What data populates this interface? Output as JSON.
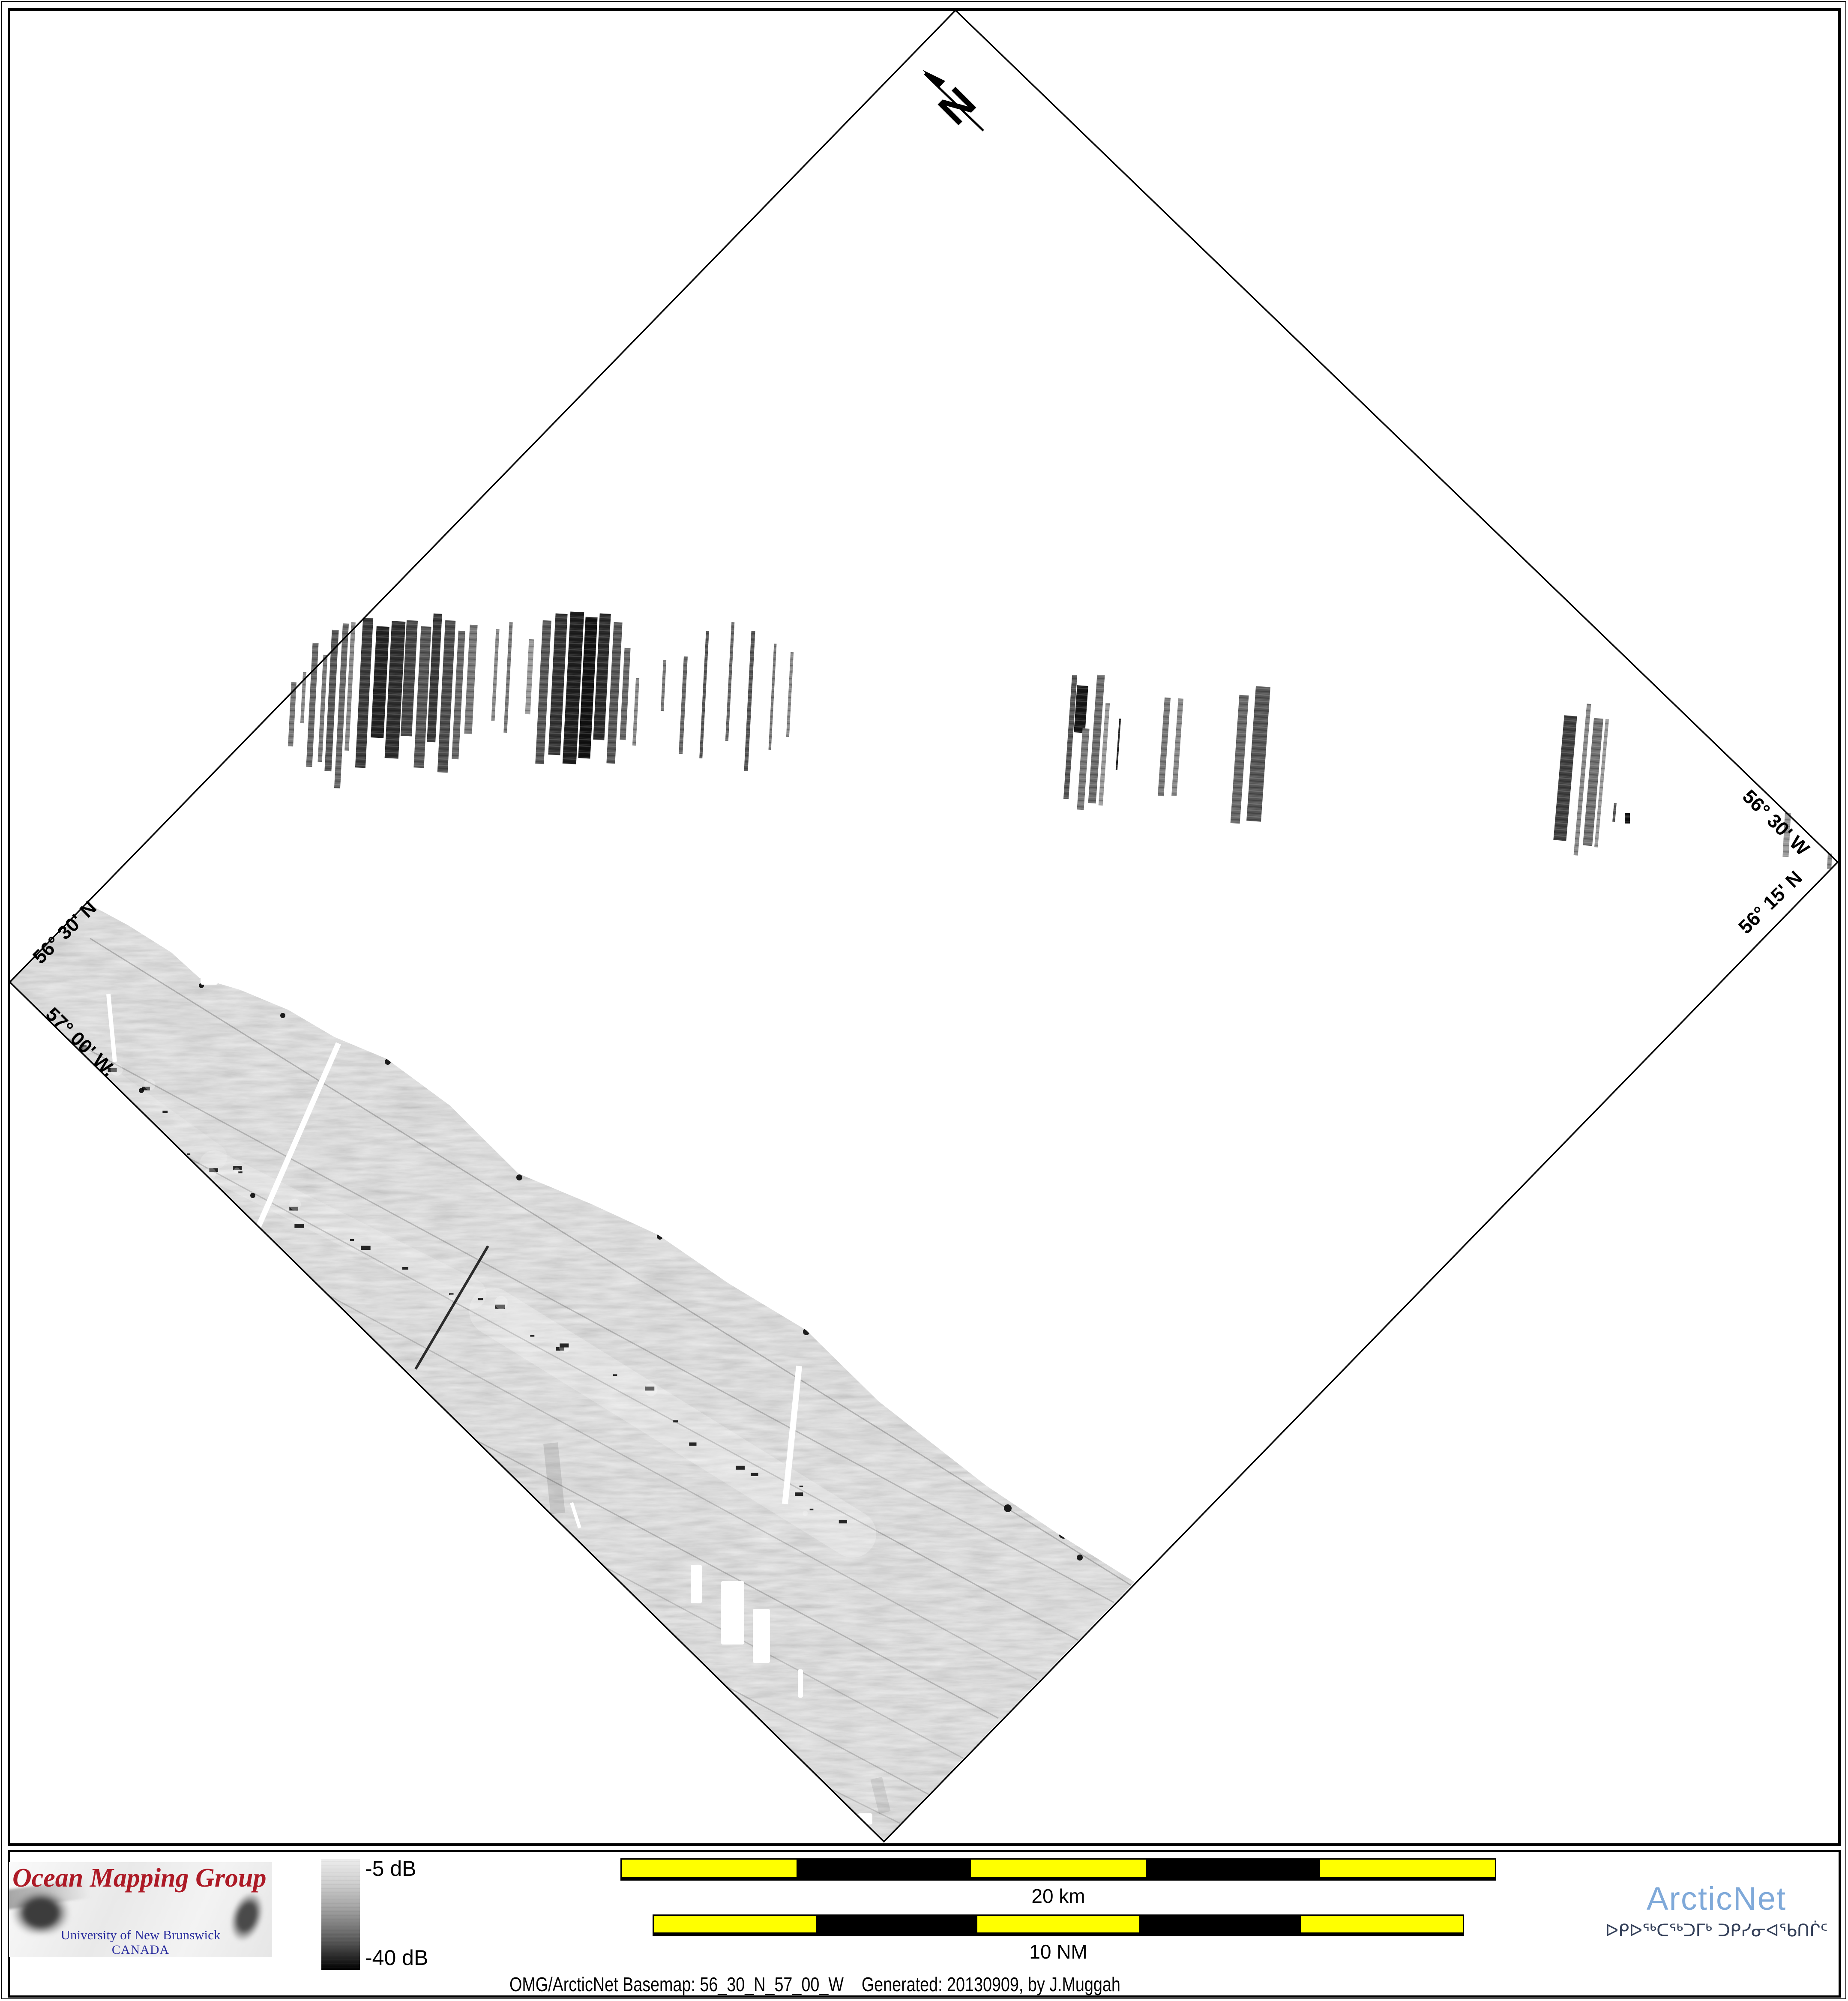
{
  "map": {
    "north_label": "N",
    "corner_labels": {
      "top_left": "56° 30' N",
      "bottom_left": "57° 00' W.",
      "top_right": "56° 30' W",
      "bottom_right": "56° 15' N"
    },
    "diamond": {
      "points": [
        [
          2230,
          24
        ],
        [
          4289,
          2012
        ],
        [
          2063,
          4298
        ],
        [
          23,
          2292
        ]
      ]
    },
    "swath": {
      "base_gray": "#b5b5b5",
      "points": [
        [
          207,
          2110
        ],
        [
          300,
          2160
        ],
        [
          400,
          2223
        ],
        [
          465,
          2282
        ],
        [
          560,
          2310
        ],
        [
          673,
          2357
        ],
        [
          780,
          2420
        ],
        [
          902,
          2471
        ],
        [
          1050,
          2580
        ],
        [
          1210,
          2739
        ],
        [
          1380,
          2810
        ],
        [
          1536,
          2882
        ],
        [
          1700,
          2995
        ],
        [
          1881,
          3104
        ],
        [
          2050,
          3270
        ],
        [
          2300,
          3466
        ],
        [
          2470,
          3580
        ],
        [
          2648,
          3692
        ],
        [
          2063,
          4295
        ],
        [
          23,
          2292
        ]
      ],
      "tracklines": [
        [
          210,
          2190,
          2640,
          3700,
          0.2
        ],
        [
          40,
          2360,
          2600,
          3740,
          0.18
        ],
        [
          30,
          2480,
          2520,
          3830,
          0.2
        ],
        [
          60,
          2640,
          2420,
          3920,
          0.15
        ],
        [
          150,
          2850,
          2330,
          4010,
          0.18
        ],
        [
          330,
          3080,
          2260,
          4110,
          0.14
        ],
        [
          560,
          3330,
          2190,
          4200,
          0.16
        ],
        [
          820,
          3620,
          2130,
          4270,
          0.13
        ]
      ],
      "light_bands": [
        [
          1150,
          3060,
          1990,
          3580,
          110,
          0.25
        ],
        [
          500,
          2720,
          1100,
          3020,
          70,
          0.2
        ],
        [
          250,
          2520,
          500,
          2700,
          60,
          0.15
        ]
      ],
      "smudges": [
        [
          1139,
          2908,
          970,
          3195,
          6,
          0.8
        ],
        [
          1285,
          3368,
          1302,
          3532,
          34,
          0.1
        ],
        [
          2045,
          4150,
          2065,
          4230,
          28,
          0.08
        ]
      ],
      "chain": {
        "points": [
          [
            170,
            2395
          ],
          [
            256,
            2500
          ],
          [
            360,
            2600
          ],
          [
            464,
            2705
          ],
          [
            560,
            2760
          ],
          [
            700,
            2830
          ],
          [
            850,
            2905
          ],
          [
            1000,
            2975
          ],
          [
            1150,
            3050
          ],
          [
            1240,
            3114
          ],
          [
            1380,
            3200
          ],
          [
            1536,
            3290
          ],
          [
            1700,
            3390
          ],
          [
            1810,
            3460
          ],
          [
            1907,
            3529
          ],
          [
            2000,
            3600
          ]
        ],
        "dots_per_segment": 2,
        "jitter": 26,
        "size_min": 5,
        "size_max": 14
      },
      "specks": [
        [
          1212,
          2748,
          7
        ],
        [
          1540,
          2886,
          7
        ],
        [
          1882,
          3108,
          8
        ],
        [
          2352,
          3520,
          9
        ],
        [
          2482,
          3580,
          11
        ],
        [
          660,
          2370,
          6
        ],
        [
          905,
          2478,
          7
        ],
        [
          470,
          2300,
          6
        ],
        [
          2520,
          3635,
          7
        ],
        [
          330,
          2545,
          6
        ],
        [
          590,
          2790,
          6
        ]
      ],
      "gaps": [
        [
          790,
          2435,
          600,
          2870,
          13
        ],
        [
          253,
          2320,
          268,
          2478,
          10
        ],
        [
          1865,
          3188,
          1832,
          3510,
          14
        ],
        [
          1334,
          3507,
          1353,
          3566,
          8
        ]
      ],
      "blobs": [
        [
          1612,
          3652,
          26,
          90
        ],
        [
          1683,
          3690,
          54,
          148
        ],
        [
          1757,
          3755,
          40,
          126
        ],
        [
          1702,
          3948,
          14,
          165
        ],
        [
          1755,
          4058,
          11,
          105
        ],
        [
          1862,
          3896,
          12,
          66
        ],
        [
          2320,
          4072,
          78,
          42
        ],
        [
          2002,
          4232,
          34,
          26
        ],
        [
          468,
          2272,
          40,
          26
        ]
      ]
    },
    "strips": [
      [
        676,
        1592,
        12,
        150,
        "#777777",
        3
      ],
      [
        704,
        1568,
        8,
        120,
        "#888888",
        3
      ],
      [
        722,
        1500,
        14,
        290,
        "#666666",
        3
      ],
      [
        748,
        1528,
        10,
        250,
        "#777777",
        3
      ],
      [
        766,
        1470,
        16,
        330,
        "#555555",
        3
      ],
      [
        790,
        1455,
        14,
        385,
        "#666666",
        3
      ],
      [
        812,
        1452,
        10,
        300,
        "#888888",
        3
      ],
      [
        838,
        1442,
        24,
        350,
        "#3a3a3a",
        3
      ],
      [
        872,
        1462,
        30,
        260,
        "#222222",
        3
      ],
      [
        906,
        1450,
        32,
        320,
        "#2d2d2d",
        3
      ],
      [
        942,
        1448,
        26,
        270,
        "#444444",
        3
      ],
      [
        974,
        1462,
        24,
        330,
        "#555555",
        3
      ],
      [
        1004,
        1432,
        20,
        300,
        "#383838",
        3
      ],
      [
        1030,
        1448,
        24,
        355,
        "#4a4a4a",
        3
      ],
      [
        1062,
        1472,
        16,
        300,
        "#666666",
        3
      ],
      [
        1090,
        1458,
        18,
        255,
        "#777777",
        3
      ],
      [
        1152,
        1468,
        8,
        215,
        "#888888",
        3
      ],
      [
        1182,
        1452,
        8,
        258,
        "#777777",
        3
      ],
      [
        1230,
        1492,
        12,
        175,
        "#999999",
        3
      ],
      [
        1258,
        1448,
        20,
        335,
        "#555555",
        3
      ],
      [
        1288,
        1432,
        28,
        330,
        "#333333",
        3
      ],
      [
        1322,
        1428,
        32,
        355,
        "#1e1e1e",
        3
      ],
      [
        1358,
        1440,
        28,
        330,
        "#111111",
        3
      ],
      [
        1392,
        1432,
        26,
        295,
        "#2a2a2a",
        3
      ],
      [
        1424,
        1452,
        20,
        330,
        "#555555",
        3
      ],
      [
        1452,
        1512,
        14,
        215,
        "#666666",
        3
      ],
      [
        1480,
        1582,
        8,
        158,
        "#888888",
        3
      ],
      [
        1545,
        1540,
        7,
        120,
        "#777777",
        3
      ],
      [
        1590,
        1532,
        9,
        228,
        "#666666",
        3
      ],
      [
        1640,
        1472,
        7,
        298,
        "#555555",
        3
      ],
      [
        1700,
        1452,
        7,
        278,
        "#666666",
        3
      ],
      [
        1745,
        1472,
        9,
        328,
        "#555555",
        3
      ],
      [
        1800,
        1502,
        6,
        248,
        "#777777",
        3
      ],
      [
        1840,
        1522,
        7,
        198,
        "#888888",
        3
      ],
      [
        2492,
        1575,
        12,
        290,
        "#555555",
        4
      ],
      [
        2510,
        1600,
        26,
        110,
        "#161616",
        4
      ],
      [
        2520,
        1700,
        16,
        190,
        "#777777",
        4
      ],
      [
        2550,
        1575,
        18,
        300,
        "#6a6a6a",
        4
      ],
      [
        2572,
        1640,
        10,
        240,
        "#999999",
        4
      ],
      [
        2608,
        1677,
        4,
        120,
        "#222222",
        4
      ],
      [
        2710,
        1628,
        14,
        230,
        "#777777",
        4
      ],
      [
        2742,
        1630,
        12,
        228,
        "#888888",
        4
      ],
      [
        2882,
        1622,
        22,
        300,
        "#666666",
        4
      ],
      [
        2920,
        1602,
        34,
        315,
        "#555555",
        4
      ],
      [
        3638,
        1670,
        30,
        292,
        "#3f3f3f",
        5
      ],
      [
        3688,
        1642,
        10,
        355,
        "#888888",
        5
      ],
      [
        3707,
        1676,
        22,
        298,
        "#6f6f6f",
        5
      ],
      [
        3734,
        1678,
        8,
        300,
        "#999999",
        5
      ],
      [
        3765,
        1874,
        6,
        44,
        "#555555",
        5
      ],
      [
        3792,
        1898,
        12,
        24,
        "#111111",
        0
      ],
      [
        4163,
        1898,
        14,
        102,
        "#999999",
        3
      ],
      [
        4265,
        1992,
        10,
        36,
        "#888888",
        3
      ]
    ]
  },
  "footer": {
    "omg_logo": {
      "title": "Ocean Mapping Group",
      "line1": "University of New Brunswick",
      "line2": "CANADA",
      "title_color": "#ad1a26",
      "text_color": "#2a2d9e"
    },
    "colorbar": {
      "top_label": "-5 dB",
      "bottom_label": "-40 dB"
    },
    "scalebars": [
      {
        "label": "20 km",
        "segments": [
          "#ffff00",
          "#000000",
          "#ffff00",
          "#000000",
          "#ffff00"
        ]
      },
      {
        "label": "10 NM",
        "segments": [
          "#ffff00",
          "#000000",
          "#ffff00",
          "#000000",
          "#ffff00"
        ]
      }
    ],
    "caption": "OMG/ArcticNet Basemap: 56_30_N_57_00_W    Generated: 20130909, by J.Muggah",
    "arcticnet": {
      "name": "ArcticNet",
      "syllabics": "ᐅᑭᐅᖅᑕᖅᑐᒥᒃ ᑐᑭᓯᓂᐊᖃᑎᒌᑦ",
      "name_color": "#7fa9d9",
      "syllabics_color": "#35415a"
    }
  }
}
